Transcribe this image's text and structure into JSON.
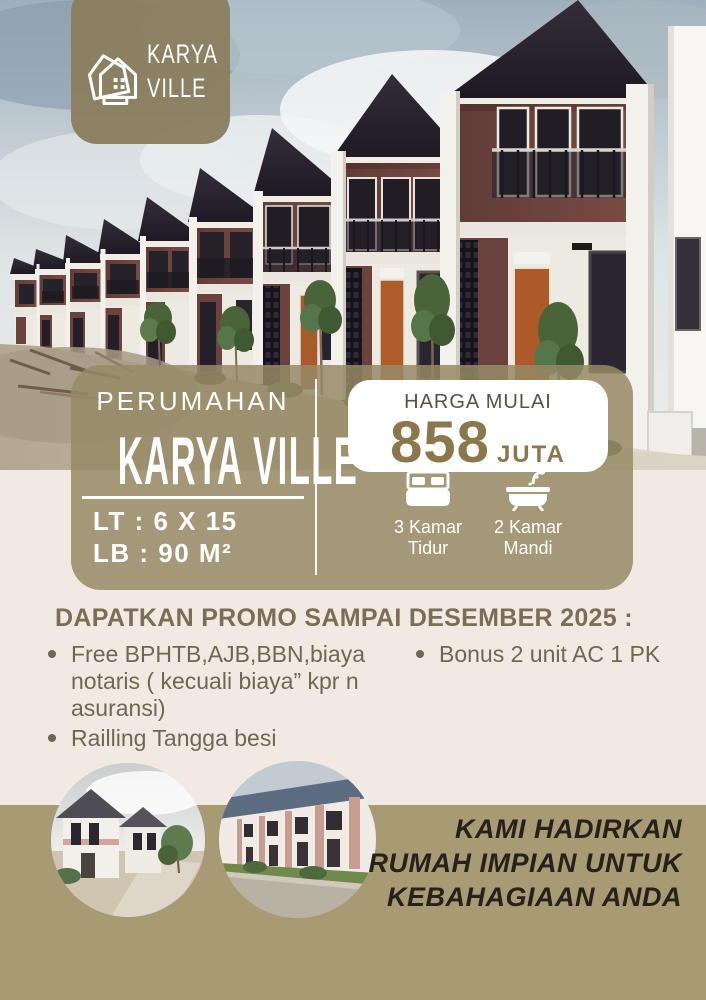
{
  "logo": {
    "line1": "KARYA",
    "line2": "VILLE"
  },
  "panel": {
    "subtitle": "PERUMAHAN",
    "title": "KARYA VILLE",
    "land": "LT : 6 X 15",
    "building": "LB : 90 M²",
    "price_label": "HARGA MULAI",
    "price_amount": "858",
    "price_unit": "JUTA",
    "features": [
      {
        "icon": "bed-icon",
        "line1": "3 Kamar",
        "line2": "Tidur"
      },
      {
        "icon": "bath-icon",
        "line1": "2 Kamar",
        "line2": "Mandi"
      }
    ]
  },
  "promo": {
    "heading": "DAPATKAN PROMO SAMPAI DESEMBER 2025 :",
    "left_bullets": [
      "Free BPHTB,AJB,BBN,biaya notaris ( kecuali biaya” kpr n asuransi)",
      "Railling Tangga besi"
    ],
    "right_bullets": [
      "Bonus 2 unit AC 1 PK"
    ]
  },
  "tagline": {
    "line1": "KAMI HADIRKAN",
    "line2": "RUMAH IMPIAN UNTUK",
    "line3": "KEBAHAGIAAN ANDA"
  },
  "colors": {
    "band": "#a89a73",
    "panel_overlay": "rgba(150,137,102,0.85)",
    "price_accent": "#8b774b",
    "promo_text": "#6f6754",
    "background": "#f2e9e3"
  }
}
